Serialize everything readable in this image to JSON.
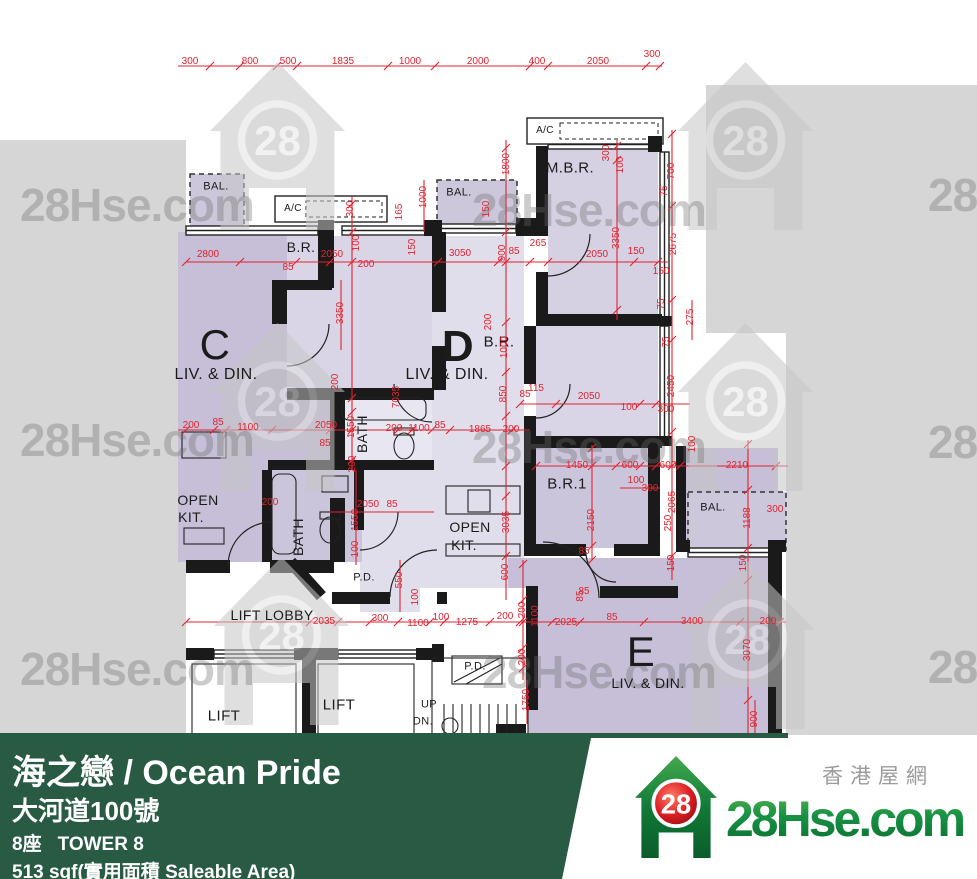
{
  "watermark": {
    "text": "28Hse.com",
    "logo_number": "28"
  },
  "brand": {
    "site_name": "28Hse.com",
    "site_tagline_cn": "香港屋網",
    "logo_number": "28"
  },
  "footer": {
    "title": "海之戀 / Ocean Pride",
    "address": "大河道100號",
    "tower_cn": "8座",
    "tower_en": "TOWER 8",
    "area": "513 sqf(實用面積 Saleable Area)"
  },
  "plan": {
    "colors": {
      "dim_red": "#e02330",
      "wall_black": "#1a1a1a",
      "room_dark": "#c6bfd7",
      "room_mid": "#d5d0e2",
      "room_light": "#e1deec",
      "balcony": "#cdc7dc",
      "bg_gray": "#d6d6d6",
      "footer_green": "#285a44"
    },
    "rooms": [
      {
        "t": "C",
        "x": 215,
        "y": 345,
        "s": 42,
        "w": 500
      },
      {
        "t": "LIV. & DIN.",
        "x": 216,
        "y": 375,
        "s": 16
      },
      {
        "t": "D",
        "x": 458,
        "y": 347,
        "s": 44,
        "w": 700
      },
      {
        "t": "LIV. & DIN.",
        "x": 447,
        "y": 375,
        "s": 16
      },
      {
        "t": "E",
        "x": 641,
        "y": 652,
        "s": 42,
        "w": 500
      },
      {
        "t": "LIV. & DIN.",
        "x": 648,
        "y": 683,
        "s": 14
      },
      {
        "t": "M.B.R.",
        "x": 570,
        "y": 168,
        "s": 15
      },
      {
        "t": "B.R.",
        "x": 301,
        "y": 247,
        "s": 14
      },
      {
        "t": "B.R.",
        "x": 499,
        "y": 342,
        "s": 15
      },
      {
        "t": "B.R.1",
        "x": 567,
        "y": 484,
        "s": 15
      },
      {
        "t": "BATH",
        "x": 362,
        "y": 434,
        "s": 14,
        "r": 1
      },
      {
        "t": "BATH",
        "x": 298,
        "y": 537,
        "s": 14,
        "r": 1
      },
      {
        "t": "OPEN",
        "x": 198,
        "y": 500,
        "s": 14
      },
      {
        "t": "KIT.",
        "x": 191,
        "y": 517,
        "s": 14
      },
      {
        "t": "OPEN",
        "x": 470,
        "y": 527,
        "s": 14
      },
      {
        "t": "KIT.",
        "x": 464,
        "y": 545,
        "s": 14
      },
      {
        "t": "BAL.",
        "x": 216,
        "y": 187,
        "s": 11
      },
      {
        "t": "BAL.",
        "x": 459,
        "y": 193,
        "s": 11
      },
      {
        "t": "BAL.",
        "x": 713,
        "y": 508,
        "s": 11
      },
      {
        "t": "A/C",
        "x": 293,
        "y": 209,
        "s": 10
      },
      {
        "t": "A/C",
        "x": 545,
        "y": 131,
        "s": 10
      },
      {
        "t": "P.D.",
        "x": 364,
        "y": 578,
        "s": 11
      },
      {
        "t": "P.D.",
        "x": 475,
        "y": 667,
        "s": 11
      },
      {
        "t": "LIFT LOBBY",
        "x": 272,
        "y": 615,
        "s": 14
      },
      {
        "t": "LIFT",
        "x": 224,
        "y": 716,
        "s": 15
      },
      {
        "t": "LIFT",
        "x": 339,
        "y": 705,
        "s": 15
      },
      {
        "t": "UP",
        "x": 429,
        "y": 705,
        "s": 11
      },
      {
        "t": "DN.",
        "x": 423,
        "y": 722,
        "s": 11
      }
    ],
    "dims": [
      [
        "300",
        190,
        62
      ],
      [
        "800",
        250,
        62
      ],
      [
        "500",
        288,
        62
      ],
      [
        "1835",
        343,
        62
      ],
      [
        "1000",
        410,
        62
      ],
      [
        "2000",
        478,
        62
      ],
      [
        "400",
        537,
        62
      ],
      [
        "2050",
        598,
        62
      ],
      [
        "300",
        652,
        55
      ],
      [
        "2800",
        208,
        255
      ],
      [
        "85",
        288,
        268
      ],
      [
        "2050",
        332,
        255
      ],
      [
        "200",
        366,
        265
      ],
      [
        "3050",
        460,
        254
      ],
      [
        "900",
        503,
        253,
        1
      ],
      [
        "85",
        514,
        252
      ],
      [
        "265",
        538,
        244
      ],
      [
        "2050",
        597,
        255
      ],
      [
        "150",
        636,
        252
      ],
      [
        "150",
        661,
        272
      ],
      [
        "300",
        351,
        209,
        1
      ],
      [
        "100",
        357,
        243,
        1
      ],
      [
        "165",
        400,
        212,
        1
      ],
      [
        "150",
        413,
        247,
        1
      ],
      [
        "1000",
        424,
        197,
        1
      ],
      [
        "150",
        487,
        209,
        1
      ],
      [
        "1800",
        507,
        164,
        1
      ],
      [
        "300",
        607,
        153,
        1
      ],
      [
        "100",
        621,
        165,
        1
      ],
      [
        "3350",
        617,
        238,
        1
      ],
      [
        "700",
        672,
        171,
        1
      ],
      [
        "75",
        665,
        191,
        1
      ],
      [
        "2675",
        674,
        244,
        1
      ],
      [
        "75",
        662,
        304,
        1
      ],
      [
        "275",
        691,
        317,
        1
      ],
      [
        "75",
        667,
        342,
        1
      ],
      [
        "2450",
        672,
        386,
        1
      ],
      [
        "3350",
        341,
        313,
        1
      ],
      [
        "200",
        336,
        382,
        1
      ],
      [
        "7035",
        397,
        397,
        1
      ],
      [
        "200",
        489,
        322,
        1
      ],
      [
        "1000",
        505,
        347,
        1
      ],
      [
        "850",
        504,
        394,
        1
      ],
      [
        "85",
        525,
        395
      ],
      [
        "115",
        536,
        389
      ],
      [
        "2050",
        589,
        397
      ],
      [
        "100",
        629,
        408
      ],
      [
        "300",
        666,
        410
      ],
      [
        "200",
        191,
        426
      ],
      [
        "85",
        218,
        423
      ],
      [
        "1100",
        248,
        428
      ],
      [
        "2050",
        326,
        426
      ],
      [
        "1550",
        352,
        427,
        1
      ],
      [
        "85",
        325,
        444
      ],
      [
        "200",
        394,
        429
      ],
      [
        "1100",
        419,
        429
      ],
      [
        "85",
        440,
        426
      ],
      [
        "1865",
        480,
        430
      ],
      [
        "200",
        511,
        430
      ],
      [
        "1450",
        577,
        466
      ],
      [
        "600",
        630,
        466
      ],
      [
        "100",
        636,
        481
      ],
      [
        "300",
        650,
        489
      ],
      [
        "2150",
        592,
        520,
        1
      ],
      [
        "85",
        584,
        552
      ],
      [
        "85",
        584,
        592
      ],
      [
        "600",
        668,
        466
      ],
      [
        "2210",
        737,
        466
      ],
      [
        "100",
        693,
        444,
        1
      ],
      [
        "2065",
        673,
        502,
        1
      ],
      [
        "250",
        669,
        523,
        1
      ],
      [
        "300",
        775,
        510
      ],
      [
        "1188",
        748,
        518,
        1
      ],
      [
        "150",
        672,
        563,
        1
      ],
      [
        "150",
        744,
        563,
        1
      ],
      [
        "3035",
        507,
        522,
        1
      ],
      [
        "600",
        506,
        572,
        1
      ],
      [
        "2050",
        368,
        505
      ],
      [
        "85",
        392,
        505
      ],
      [
        "1550",
        356,
        520,
        1
      ],
      [
        "100",
        356,
        549,
        1
      ],
      [
        "200",
        270,
        503
      ],
      [
        "200",
        353,
        464,
        1
      ],
      [
        "550",
        400,
        580,
        1
      ],
      [
        "100",
        416,
        597,
        1
      ],
      [
        "2035",
        324,
        622
      ],
      [
        "300",
        380,
        619
      ],
      [
        "1100",
        418,
        624
      ],
      [
        "100",
        441,
        618
      ],
      [
        "1275",
        467,
        623
      ],
      [
        "200",
        505,
        617
      ],
      [
        "200",
        523,
        610,
        1
      ],
      [
        "1100",
        536,
        616,
        1
      ],
      [
        "2025",
        566,
        623
      ],
      [
        "85",
        612,
        618
      ],
      [
        "3400",
        692,
        622
      ],
      [
        "200",
        768,
        622
      ],
      [
        "3070",
        748,
        650,
        1
      ],
      [
        "200",
        523,
        657,
        1
      ],
      [
        "1750",
        527,
        700,
        1
      ],
      [
        "900",
        755,
        719,
        1
      ],
      [
        "85",
        581,
        596,
        1
      ]
    ]
  }
}
